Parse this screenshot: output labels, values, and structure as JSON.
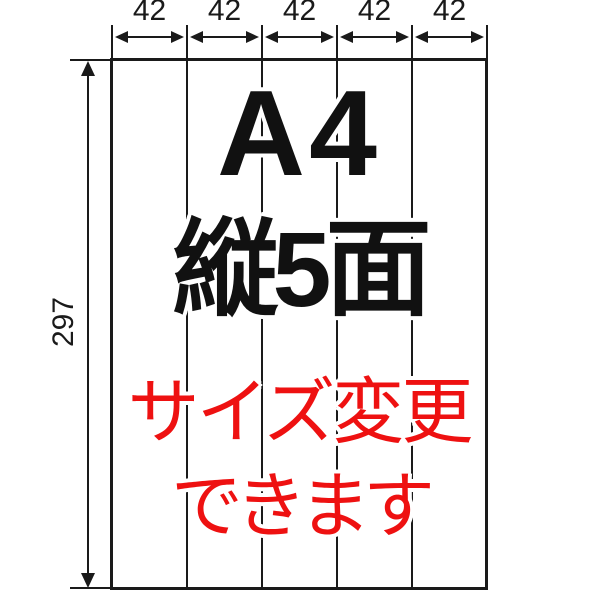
{
  "colors": {
    "background": "#ffffff",
    "line": "#1a1a1a",
    "title_text": "#111111",
    "note_text": "#ee1111"
  },
  "top_dimension": {
    "labels": [
      "42",
      "42",
      "42",
      "42",
      "42"
    ]
  },
  "left_dimension": {
    "label": "297"
  },
  "sheet": {
    "columns": 5,
    "title_line1": "A4",
    "title_line2": "縦5面",
    "note_line1": "サイズ変更",
    "note_line2": "できます"
  }
}
